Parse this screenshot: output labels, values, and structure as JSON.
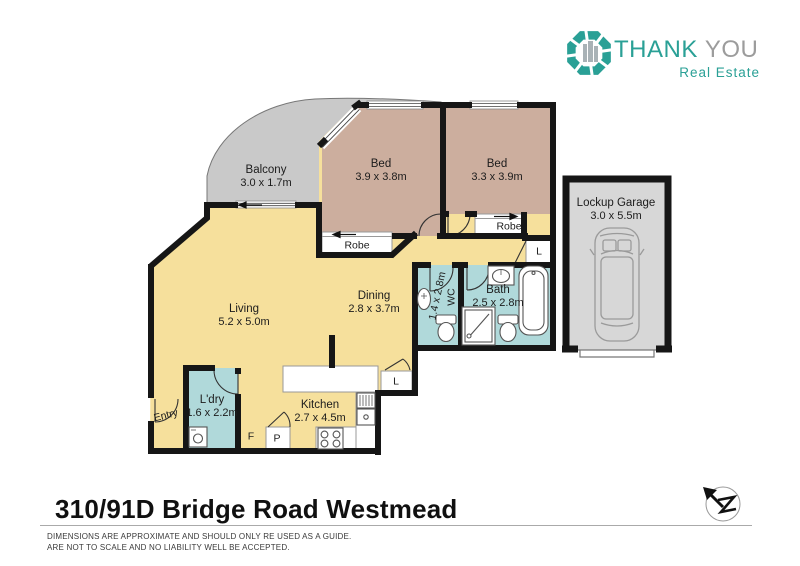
{
  "logo": {
    "word1": "THANK",
    "word2": "YOU",
    "tagline": "Real Estate"
  },
  "rooms": {
    "balcony": {
      "name": "Balcony",
      "dims": "3.0 x 1.7m"
    },
    "bed1": {
      "name": "Bed",
      "dims": "3.9 x 3.8m"
    },
    "bed2": {
      "name": "Bed",
      "dims": "3.3 x 3.9m"
    },
    "garage": {
      "name": "Lockup Garage",
      "dims": "3.0 x 5.5m"
    },
    "living": {
      "name": "Living",
      "dims": "5.2 x 5.0m"
    },
    "dining": {
      "name": "Dining",
      "dims": "2.8 x 3.7m"
    },
    "wc": {
      "name": "WC",
      "dims": "1.4 x 2.8m"
    },
    "bath": {
      "name": "Bath",
      "dims": "2.5 x 2.8m"
    },
    "laundry": {
      "name": "L'dry",
      "dims": "1.6 x 2.2m"
    },
    "kitchen": {
      "name": "Kitchen",
      "dims": "2.7 x 4.5m"
    }
  },
  "labels": {
    "robe1": "Robe",
    "robe2": "Robe",
    "linen_hall": "L",
    "linen_kitchen": "L",
    "fridge": "F",
    "pantry": "P",
    "entry": "Entry"
  },
  "footer": {
    "address": "310/91D Bridge Road Westmead",
    "disclaimer_line1": "DIMENSIONS ARE APPROXIMATE AND SHOULD ONLY RE USED AS A GUIDE.",
    "disclaimer_line2": "ARE NOT TO SCALE AND NO LIABILITY WELL BE ACCEPTED."
  },
  "colors": {
    "wall": "#161616",
    "floor-yellow": "#f6e09c",
    "floor-tan": "#ccae9e",
    "floor-teal": "#b0d9da",
    "balcony-gray": "#c9c9c9",
    "garage-gray": "#d7d7d7",
    "brand-teal": "#2aa096",
    "brand-gray": "#9c9c9c"
  }
}
